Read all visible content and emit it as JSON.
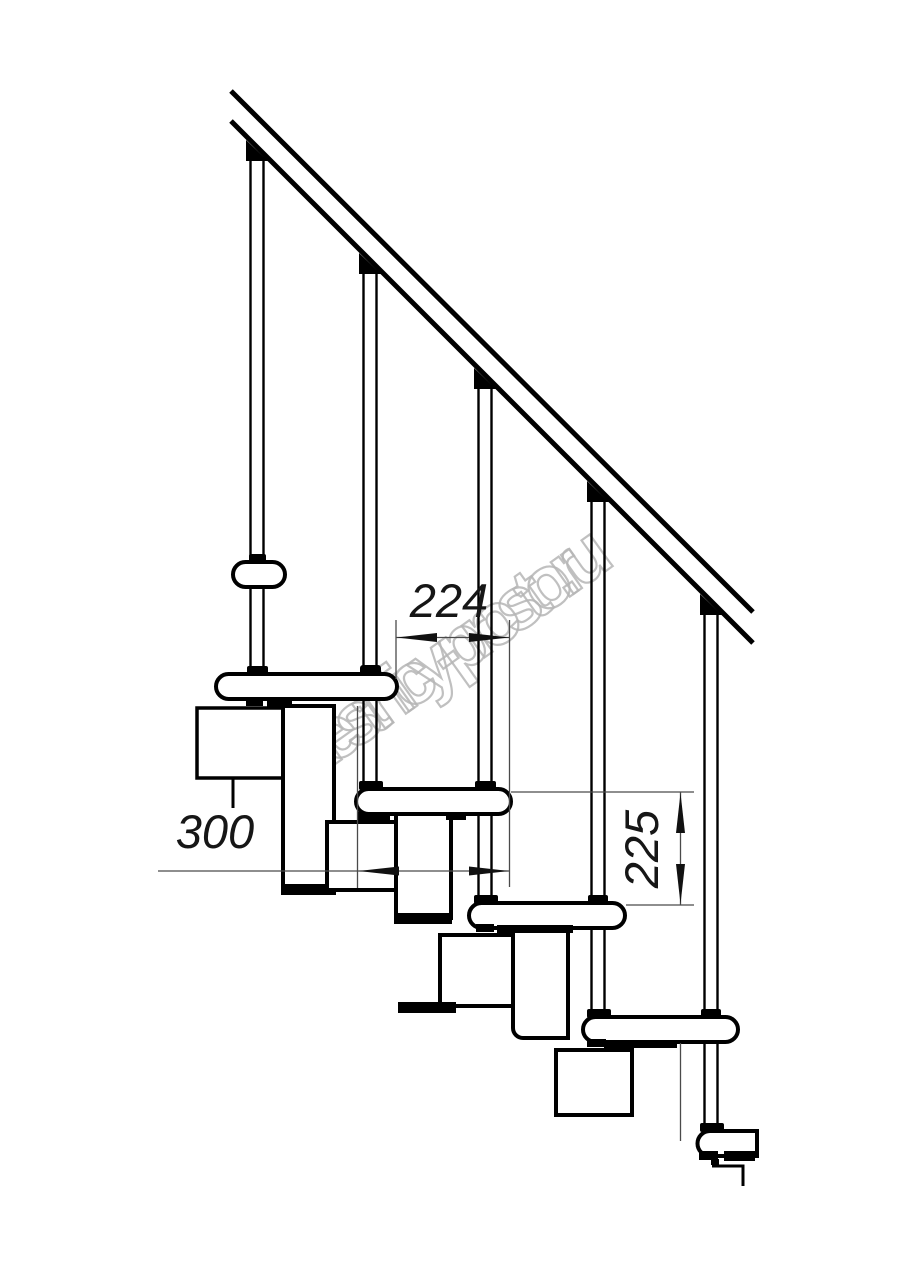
{
  "page": {
    "kind": "technical-drawing",
    "subject": "modular staircase side elevation",
    "background_color": "#ffffff",
    "line_color": "#000000",
    "dim_line_color": "#4a4a4a",
    "dim_text_color": "#161616"
  },
  "watermark": {
    "text": "lestnicy-prosto.ru",
    "color": "#b5b5b5",
    "angle_deg": -35.5
  },
  "drawing": {
    "handrail": {
      "name": "handrail",
      "segments": 2
    },
    "balusters": {
      "count": 5
    },
    "treads": {
      "count": 6
    },
    "modules": {
      "count": 7
    },
    "dimensions": {
      "going": {
        "value": "224",
        "orientation": "horizontal"
      },
      "depth": {
        "value": "300",
        "orientation": "horizontal"
      },
      "rise": {
        "value": "225",
        "orientation": "vertical"
      }
    }
  }
}
